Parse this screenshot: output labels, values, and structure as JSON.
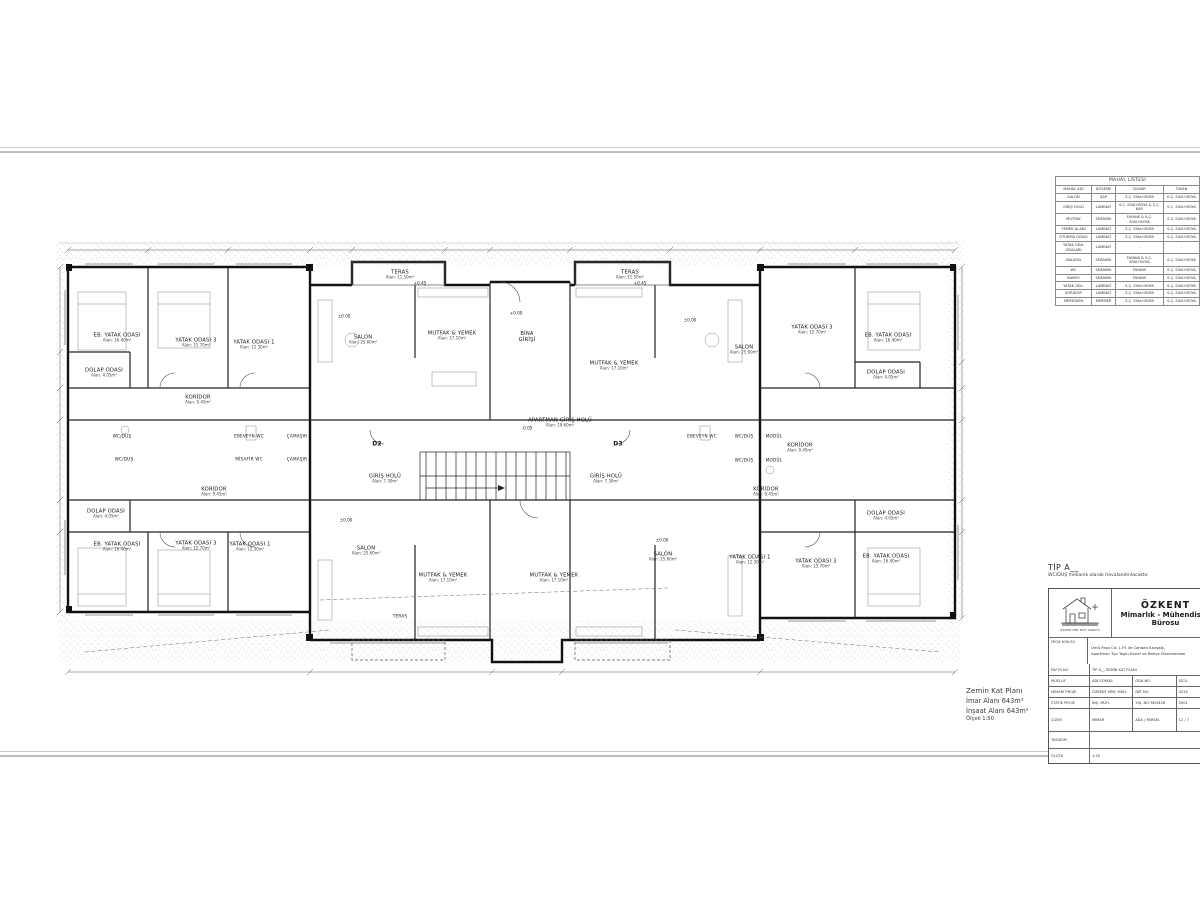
{
  "accent_colors": {
    "line": "#111111",
    "light_line": "#8a8a8a",
    "paper": "#ffffff"
  },
  "plan_info": {
    "line1": "Zemin Kat Planı",
    "line2": "İmar Alanı 643m²",
    "line3": "İnşaat Alanı 643m²",
    "line4": "Ölçek 1:50"
  },
  "tip_block": {
    "heading": "TİP A__",
    "note": "WC/DUŞ mekanik olarak havalandırılacaktır."
  },
  "finish_table": {
    "title": "MAHAL LİSTESİ",
    "columns": [
      "MAHAL ADI",
      "DÖŞEME",
      "DUVAR",
      "TAVAN"
    ],
    "rows": [
      [
        "SALON",
        "ŞAP",
        "S.Ç. SIVA+BOYA",
        "K.Ç. SIVA+BOYA"
      ],
      [
        "GİRİŞ HOLÜ",
        "LAMİNAT",
        "S.Ç. SIVA+BOYA & Ç.Ç. KAP.",
        "S.Ç. SIVA+BOYA"
      ],
      [
        "MUTFAK",
        "SERAMİK",
        "FAYANS & S.Ç. SIVA+BOYA",
        "S.Ç. SIVA+BOYA"
      ],
      [
        "YEMEK ALANI",
        "LAMİNAT",
        "S.Ç. SIVA+BOYA",
        "S.Ç. SIVA+BOYA"
      ],
      [
        "OTURMA ODASI",
        "LAMİNAT",
        "S.Ç. SIVA+BOYA",
        "S.Ç. SIVA+BOYA"
      ],
      [
        "YATAK ODA. ODALARI",
        "LAMİNAT",
        "-",
        "-"
      ],
      [
        "BALKON",
        "SERAMİK",
        "FAYANS & S.Ç. SIVA+BOYA",
        "S.Ç. SIVA+BOYA"
      ],
      [
        "WC",
        "SERAMİK",
        "FAYANS",
        "S.Ç. SIVA+BOYA"
      ],
      [
        "BANYO",
        "SERAMİK",
        "FAYANS",
        "S.Ç. SIVA+BOYA"
      ],
      [
        "YATAK ODL.",
        "LAMİNAT",
        "S.Ç. SIVA+BOYA",
        "S.Ç. SIVA+BOYA"
      ],
      [
        "KORİDOR",
        "LAMİNAT",
        "S.Ç. SIVA+BOYA",
        "S.Ç. SIVA+BOYA"
      ],
      [
        "MERDİVEN",
        "MERMER",
        "S.Ç. SIVA+BOYA",
        "S.Ç. SIVA+BOYA"
      ]
    ]
  },
  "title_block": {
    "firm1": "ÖZKENT",
    "firm2": "Mimarlık  -  Mühendislik",
    "firm3": "Bürosu",
    "logo_caption": "ÖZKENT MİM. MÜH. KONUTU",
    "project_label": "PROJE KONUSU",
    "project_line1": "Ümit Paşa Cd. L.F5 ile Candan Kavşağı,",
    "project_line2": "Apartman Tipi Toplu Konut ve Bahçe Düzenlemesi",
    "rows": [
      [
        "PAFTA NO",
        "TİP A__  ZEMİN KAT PLANI"
      ],
      [
        "MÜELLİF",
        "ADI SOYADI",
        "ODA NO",
        "SİCİL"
      ],
      [
        "MİMARİ PROJE",
        "ÖZKENT MİM. MÜH.",
        "DİP. NO",
        "4215"
      ],
      [
        "STATİK PROJE",
        "İNŞ. MÜH.",
        "Y.İŞ. NO 96/3428",
        "2001"
      ],
      [
        "ÇİZEN",
        "MİMAR",
        "ADA / PARSEL",
        "12 / 7"
      ],
      [
        "TASARIM",
        ""
      ],
      [
        "ÖLÇEK",
        "1:50"
      ]
    ]
  },
  "plan": {
    "rooms": [
      {
        "l": "EB. YATAK ODASI",
        "a": "Alan: 16.40m²",
        "x": 117,
        "y": 338
      },
      {
        "l": "YATAK ODASI 3",
        "a": "Alan: 15.70m²",
        "x": 196,
        "y": 343
      },
      {
        "l": "YATAK ODASI 1",
        "a": "Alan: 12.30m²",
        "x": 254,
        "y": 345
      },
      {
        "l": "DOLAP ODASI",
        "a": "Alan: 4.05m²",
        "x": 104,
        "y": 373
      },
      {
        "l": "KORİDOR",
        "a": "Alan: 9.45m²",
        "x": 198,
        "y": 400
      },
      {
        "l": "WC/DUŞ",
        "x": 122,
        "y": 436,
        "cls": "sm"
      },
      {
        "l": "EBEVEYN WC",
        "x": 249,
        "y": 436,
        "cls": "sm"
      },
      {
        "l": "ÇAMAŞIR",
        "x": 297,
        "y": 436,
        "cls": "sm"
      },
      {
        "l": "WC/DUŞ",
        "x": 124,
        "y": 459,
        "cls": "sm"
      },
      {
        "l": "MİSAFİR WC",
        "x": 249,
        "y": 459,
        "cls": "sm"
      },
      {
        "l": "ÇAMAŞIR",
        "x": 297,
        "y": 459,
        "cls": "sm"
      },
      {
        "l": "KORİDOR",
        "a": "Alan: 9.45m²",
        "x": 214,
        "y": 492
      },
      {
        "l": "DOLAP ODASI",
        "a": "Alan: 4.05m²",
        "x": 106,
        "y": 514
      },
      {
        "l": "EB. YATAK ODASI",
        "a": "Alan: 16.40m²",
        "x": 117,
        "y": 547
      },
      {
        "l": "YATAK ODASI 3",
        "a": "Alan: 15.70m²",
        "x": 196,
        "y": 546
      },
      {
        "l": "YATAK ODASI 1",
        "a": "Alan: 12.30m²",
        "x": 250,
        "y": 547
      },
      {
        "l": "TERAS",
        "a": "Alan: 11.50m²",
        "x": 400,
        "y": 275
      },
      {
        "l": "SALON",
        "a": "Alan: 25.60m²",
        "x": 363,
        "y": 340
      },
      {
        "l": "MUTFAK & YEMEK",
        "a": "Alan: 17.10m²",
        "x": 452,
        "y": 336
      },
      {
        "l": "BİNA",
        "l2": "GİRİŞİ",
        "x": 527,
        "y": 337
      },
      {
        "l": "APARTMAN GİRİŞ HOLÜ",
        "a": "Alan: 19.60m²",
        "x": 560,
        "y": 423
      },
      {
        "l": "TERAS",
        "a": "Alan: 11.50m²",
        "x": 630,
        "y": 275
      },
      {
        "l": "MUTFAK & YEMEK",
        "a": "Alan: 17.10m²",
        "x": 614,
        "y": 366
      },
      {
        "l": "SALON",
        "a": "Alan: 25.60m²",
        "x": 744,
        "y": 350
      },
      {
        "l": "YATAK ODASI 3",
        "a": "Alan: 15.70m²",
        "x": 812,
        "y": 330
      },
      {
        "l": "EB. YATAK ODASI",
        "a": "Alan: 16.40m²",
        "x": 888,
        "y": 338
      },
      {
        "l": "DOLAP ODASI",
        "a": "Alan: 4.05m²",
        "x": 886,
        "y": 375
      },
      {
        "l": "KORİDOR",
        "a": "Alan: 9.45m²",
        "x": 800,
        "y": 448
      },
      {
        "l": "EBEVEYN WC",
        "x": 702,
        "y": 436,
        "cls": "sm"
      },
      {
        "l": "WC/DUŞ",
        "x": 744,
        "y": 436,
        "cls": "sm"
      },
      {
        "l": "MODÜL",
        "x": 774,
        "y": 436,
        "cls": "sm"
      },
      {
        "l": "WC/DUŞ",
        "x": 744,
        "y": 460,
        "cls": "sm"
      },
      {
        "l": "MODÜL",
        "x": 774,
        "y": 460,
        "cls": "sm"
      },
      {
        "l": "KORİDOR",
        "a": "Alan: 9.45m²",
        "x": 766,
        "y": 492
      },
      {
        "l": "DOLAP ODASI",
        "a": "Alan: 4.05m²",
        "x": 886,
        "y": 516
      },
      {
        "l": "GİRİŞ HOLÜ",
        "a": "Alan: 7.30m²",
        "x": 385,
        "y": 479
      },
      {
        "l": "GİRİŞ HOLÜ",
        "a": "Alan: 7.30m²",
        "x": 606,
        "y": 479
      },
      {
        "l": "D2",
        "x": 377,
        "y": 444,
        "cls": "tag"
      },
      {
        "l": "D3",
        "x": 618,
        "y": 444,
        "cls": "tag"
      },
      {
        "l": "SALON",
        "a": "Alan: 25.60m²",
        "x": 366,
        "y": 551
      },
      {
        "l": "MUTFAK & YEMEK",
        "a": "Alan: 17.10m²",
        "x": 443,
        "y": 578
      },
      {
        "l": "MUTFAK & YEMEK",
        "a": "Alan: 17.10m²",
        "x": 554,
        "y": 578
      },
      {
        "l": "TERAS",
        "x": 400,
        "y": 616,
        "cls": "sm"
      },
      {
        "l": "SALON",
        "a": "Alan: 25.60m²",
        "x": 663,
        "y": 557
      },
      {
        "l": "YATAK ODASI 1",
        "a": "Alan: 12.30m²",
        "x": 750,
        "y": 560
      },
      {
        "l": "YATAK ODASI 3",
        "a": "Alan: 15.70m²",
        "x": 816,
        "y": 564
      },
      {
        "l": "EB. YATAK ODASI",
        "a": "Alan: 16.40m²",
        "x": 886,
        "y": 559
      }
    ],
    "levels": [
      {
        "t": "+0.00",
        "x": 516,
        "y": 313
      },
      {
        "t": "±0.00",
        "x": 344,
        "y": 316
      },
      {
        "t": "±0.00",
        "x": 690,
        "y": 320
      },
      {
        "t": "+0.45",
        "x": 420,
        "y": 283
      },
      {
        "t": "+0.45",
        "x": 640,
        "y": 283
      },
      {
        "t": "-0.05",
        "x": 527,
        "y": 428
      },
      {
        "t": "±0.00",
        "x": 346,
        "y": 520
      },
      {
        "t": "±0.00",
        "x": 662,
        "y": 540
      }
    ]
  }
}
